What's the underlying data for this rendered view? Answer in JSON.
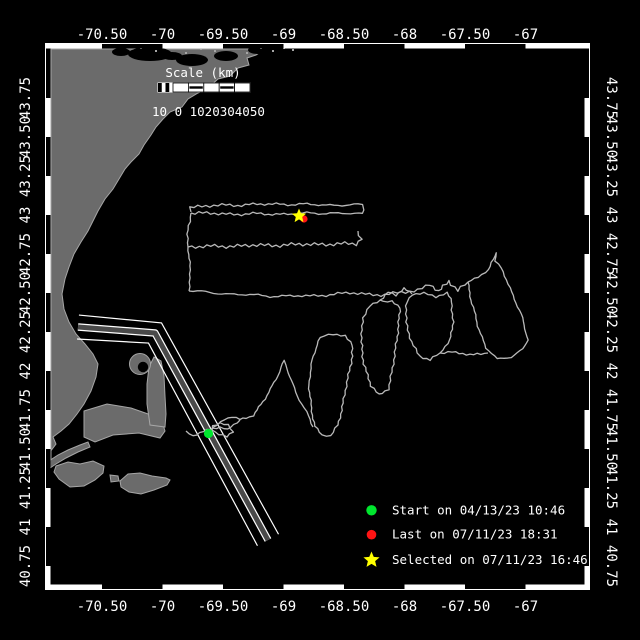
{
  "colors": {
    "background": "#000000",
    "land": "#6b6b6b",
    "land_edge": "#a6a6a6",
    "track": "#b9b9b9",
    "lane_fill": "#4a4a4a",
    "frame": "#ffffff",
    "text": "#ffffff",
    "start_green": "#00e62e",
    "last_red": "#ff1414",
    "selected_yellow": "#ffff00"
  },
  "frame": {
    "x1": 46,
    "y1": 44,
    "x2": 589,
    "y2": 589,
    "band": 4.5
  },
  "axes": {
    "lon_labels": [
      {
        "text": "-70.50",
        "x": 102
      },
      {
        "text": "-70",
        "x": 162.5
      },
      {
        "text": "-69.50",
        "x": 223
      },
      {
        "text": "-69",
        "x": 283.5
      },
      {
        "text": "-68.50",
        "x": 344
      },
      {
        "text": "-68",
        "x": 404.5
      },
      {
        "text": "-67.50",
        "x": 465
      },
      {
        "text": "-67",
        "x": 525.5
      }
    ],
    "lat_labels": [
      {
        "text": "43.75",
        "y": 98
      },
      {
        "text": "43.50",
        "y": 137
      },
      {
        "text": "43.25",
        "y": 176
      },
      {
        "text": "43",
        "y": 215
      },
      {
        "text": "42.75",
        "y": 254
      },
      {
        "text": "42.50",
        "y": 293
      },
      {
        "text": "42.25",
        "y": 332
      },
      {
        "text": "42",
        "y": 371
      },
      {
        "text": "41.75",
        "y": 410
      },
      {
        "text": "41.50",
        "y": 449
      },
      {
        "text": "41.25",
        "y": 488
      },
      {
        "text": "41",
        "y": 527
      },
      {
        "text": "40.75",
        "y": 566
      }
    ],
    "top_label_baseline": 39,
    "bottom_label_baseline": 611,
    "left_label_x": 30,
    "right_label_x": 607,
    "font_size": 14
  },
  "scalebar": {
    "title": "Scale (km)",
    "title_x": 203,
    "title_y": 77,
    "x": 158,
    "y": 83,
    "w": 92,
    "h": 9,
    "left_cells": 4,
    "left_w": 15,
    "segments": 5,
    "labels": "10 0 1020304050",
    "labels_x": 152,
    "labels_y": 116,
    "font_size": 12.5
  },
  "legend": {
    "marker_x": 371.5,
    "text_x": 392,
    "font_size": 12.5,
    "rows": [
      {
        "marker": "dot",
        "color": "start_green",
        "r": 5.2,
        "y": 510.3,
        "label": "Start on 04/13/23 10:46"
      },
      {
        "marker": "dot",
        "color": "last_red",
        "r": 4.8,
        "y": 534.7,
        "label": "Last on 07/11/23 18:31"
      },
      {
        "marker": "star",
        "color": "selected_yellow",
        "r": 8.5,
        "y": 560,
        "label": "Selected on 07/11/23 16:46"
      }
    ]
  },
  "markers": [
    {
      "name": "last-marker",
      "type": "dot",
      "color": "last_red",
      "x": 304,
      "y": 219,
      "r": 3.6
    },
    {
      "name": "selected-marker",
      "type": "star",
      "color": "selected_yellow",
      "x": 299,
      "y": 216,
      "r": 7.5
    },
    {
      "name": "start-marker",
      "type": "dot",
      "color": "start_green",
      "x": 208.5,
      "y": 433.5,
      "r": 4.6
    }
  ],
  "land": {
    "mainland": [
      [
        51,
        49
      ],
      [
        265,
        49
      ],
      [
        256,
        55
      ],
      [
        247,
        58
      ],
      [
        249,
        65
      ],
      [
        238,
        68
      ],
      [
        230,
        76
      ],
      [
        218,
        79
      ],
      [
        208,
        88
      ],
      [
        198,
        93
      ],
      [
        188,
        99
      ],
      [
        182,
        107
      ],
      [
        170,
        112
      ],
      [
        163,
        119
      ],
      [
        156,
        127
      ],
      [
        151,
        135
      ],
      [
        144,
        145
      ],
      [
        139,
        154
      ],
      [
        131,
        162
      ],
      [
        125,
        169
      ],
      [
        119,
        179
      ],
      [
        113,
        189
      ],
      [
        105,
        199
      ],
      [
        98,
        211
      ],
      [
        93,
        221
      ],
      [
        88,
        231
      ],
      [
        81,
        242
      ],
      [
        74,
        254
      ],
      [
        69,
        267
      ],
      [
        65,
        279
      ],
      [
        62,
        294
      ],
      [
        64,
        309
      ],
      [
        69,
        322
      ],
      [
        76,
        334
      ],
      [
        85,
        344
      ],
      [
        93,
        354
      ],
      [
        98,
        364
      ],
      [
        96,
        377
      ],
      [
        91,
        391
      ],
      [
        84,
        404
      ],
      [
        77,
        414
      ],
      [
        69,
        424
      ],
      [
        61,
        431
      ],
      [
        53,
        437
      ],
      [
        56,
        444
      ],
      [
        50,
        452
      ],
      [
        51,
        460
      ]
    ],
    "cape_arm": [
      [
        84,
        411
      ],
      [
        107,
        404
      ],
      [
        131,
        408
      ],
      [
        151,
        415
      ],
      [
        162,
        421
      ],
      [
        165,
        431
      ],
      [
        160,
        438
      ],
      [
        139,
        433
      ],
      [
        113,
        435
      ],
      [
        95,
        442
      ],
      [
        84,
        437
      ]
    ],
    "cape_forearm": [
      [
        150,
        425
      ],
      [
        147,
        404
      ],
      [
        147,
        384
      ],
      [
        149,
        367
      ],
      [
        154,
        357
      ],
      [
        161,
        361
      ],
      [
        164,
        376
      ],
      [
        165,
        396
      ],
      [
        166,
        414
      ],
      [
        165,
        427
      ]
    ],
    "hook": {
      "cx": 140,
      "cy": 364,
      "r": 10.5,
      "icx": 143,
      "icy": 367,
      "ir": 5.2
    },
    "islands": [
      [
        [
          49,
          461
        ],
        [
          58,
          455
        ],
        [
          68,
          450
        ],
        [
          80,
          445
        ],
        [
          88,
          442
        ],
        [
          90,
          447
        ],
        [
          78,
          452
        ],
        [
          66,
          458
        ],
        [
          56,
          464
        ],
        [
          50,
          468
        ]
      ],
      [
        [
          56,
          466
        ],
        [
          68,
          462
        ],
        [
          80,
          464
        ],
        [
          93,
          461
        ],
        [
          104,
          466
        ],
        [
          103,
          473
        ],
        [
          95,
          480
        ],
        [
          84,
          486
        ],
        [
          70,
          487
        ],
        [
          59,
          479
        ],
        [
          54,
          472
        ]
      ],
      [
        [
          110,
          475
        ],
        [
          118,
          476
        ],
        [
          119,
          481
        ],
        [
          111,
          482
        ]
      ],
      [
        [
          120,
          481
        ],
        [
          128,
          474
        ],
        [
          140,
          473
        ],
        [
          152,
          476
        ],
        [
          166,
          478
        ],
        [
          170,
          480
        ],
        [
          167,
          485
        ],
        [
          154,
          490
        ],
        [
          141,
          494
        ],
        [
          129,
          492
        ],
        [
          121,
          487
        ]
      ]
    ],
    "bays": [
      [
        150,
        54,
        22,
        7
      ],
      [
        192,
        60,
        16,
        6
      ],
      [
        226,
        56,
        12,
        5
      ],
      [
        258,
        50,
        10,
        4
      ],
      [
        121,
        52,
        9,
        4
      ],
      [
        172,
        56,
        10,
        4
      ]
    ],
    "speckles": [
      [
        140,
        47
      ],
      [
        155,
        50
      ],
      [
        168,
        46
      ],
      [
        185,
        52
      ],
      [
        200,
        48
      ],
      [
        214,
        50
      ],
      [
        230,
        47
      ],
      [
        246,
        52
      ],
      [
        260,
        47
      ],
      [
        272,
        50
      ],
      [
        283,
        47
      ],
      [
        292,
        49
      ]
    ]
  },
  "lane": {
    "center": [
      [
        78,
        327
      ],
      [
        155,
        333
      ],
      [
        268,
        540
      ]
    ],
    "offset": 12,
    "band_outer_w": 7.5,
    "band_inner_w": 5,
    "line_w": 1.2
  },
  "track": {
    "polylines": [
      {
        "amp": 1.6,
        "pts": [
          [
            191,
            212
          ],
          [
            190,
            207
          ],
          [
            230,
            205
          ],
          [
            280,
            204
          ],
          [
            330,
            205
          ],
          [
            362,
            205
          ],
          [
            364,
            210
          ],
          [
            363,
            214
          ],
          [
            330,
            213
          ],
          [
            280,
            214
          ],
          [
            230,
            214
          ],
          [
            191,
            213
          ]
        ]
      },
      {
        "amp": 0.8,
        "pts": [
          [
            191,
            213
          ],
          [
            188,
            230
          ],
          [
            188,
            247
          ]
        ]
      },
      {
        "amp": 1.6,
        "pts": [
          [
            188,
            247
          ],
          [
            230,
            246
          ],
          [
            280,
            245
          ],
          [
            330,
            244
          ],
          [
            356,
            244
          ],
          [
            361,
            239
          ],
          [
            358,
            231
          ]
        ]
      },
      {
        "amp": 0.8,
        "pts": [
          [
            188,
            247
          ],
          [
            190,
            262
          ],
          [
            190,
            278
          ],
          [
            189,
            291
          ]
        ]
      },
      {
        "amp": 1.5,
        "pts": [
          [
            189,
            291
          ],
          [
            230,
            294
          ],
          [
            270,
            296
          ],
          [
            310,
            296
          ],
          [
            350,
            293
          ],
          [
            385,
            295
          ],
          [
            418,
            290
          ],
          [
            430,
            284
          ],
          [
            439,
            292
          ],
          [
            449,
            281
          ],
          [
            458,
            290
          ],
          [
            468,
            282
          ]
        ]
      },
      {
        "amp": 0.9,
        "pts": [
          [
            468,
            282
          ],
          [
            471,
            300
          ],
          [
            478,
            326
          ],
          [
            486,
            348
          ],
          [
            497,
            359
          ],
          [
            511,
            357
          ],
          [
            523,
            349
          ],
          [
            528,
            340
          ],
          [
            521,
            314
          ],
          [
            510,
            288
          ],
          [
            501,
            268
          ],
          [
            495,
            261
          ],
          [
            497,
            252
          ],
          [
            493,
            259
          ],
          [
            489,
            270
          ],
          [
            478,
            277
          ],
          [
            468,
            282
          ]
        ]
      },
      {
        "amp": 1.0,
        "pts": [
          [
            488,
            353
          ],
          [
            470,
            355
          ],
          [
            452,
            352
          ],
          [
            440,
            353
          ]
        ]
      },
      {
        "amp": 0.9,
        "pts": [
          [
            440,
            353
          ],
          [
            430,
            360
          ],
          [
            420,
            356
          ],
          [
            411,
            342
          ],
          [
            406,
            322
          ],
          [
            407,
            302
          ],
          [
            412,
            294
          ],
          [
            424,
            293
          ],
          [
            436,
            297
          ],
          [
            447,
            293
          ],
          [
            452,
            302
          ],
          [
            453,
            322
          ],
          [
            450,
            340
          ],
          [
            440,
            353
          ]
        ]
      },
      {
        "amp": 0.9,
        "pts": [
          [
            412,
            294
          ],
          [
            404,
            288
          ],
          [
            396,
            296
          ],
          [
            388,
            292
          ],
          [
            380,
            300
          ],
          [
            370,
            306
          ],
          [
            363,
            318
          ],
          [
            361,
            342
          ],
          [
            364,
            364
          ],
          [
            371,
            386
          ],
          [
            379,
            395
          ],
          [
            388,
            389
          ],
          [
            393,
            368
          ],
          [
            396,
            344
          ],
          [
            399,
            322
          ],
          [
            400,
            308
          ],
          [
            392,
            301
          ],
          [
            383,
            302
          ],
          [
            380,
            300
          ]
        ]
      },
      {
        "amp": 0.9,
        "pts": [
          [
            318,
            341
          ],
          [
            312,
            360
          ],
          [
            309,
            385
          ],
          [
            311,
            408
          ],
          [
            315,
            426
          ],
          [
            322,
            435
          ],
          [
            331,
            436
          ],
          [
            338,
            425
          ],
          [
            343,
            403
          ],
          [
            348,
            378
          ],
          [
            352,
            356
          ],
          [
            353,
            345
          ],
          [
            345,
            336
          ],
          [
            333,
            334
          ],
          [
            324,
            336
          ],
          [
            318,
            341
          ]
        ]
      },
      {
        "amp": 1.2,
        "pts": [
          [
            313,
            427
          ],
          [
            308,
            416
          ],
          [
            302,
            404
          ],
          [
            296,
            392
          ],
          [
            291,
            380
          ],
          [
            287,
            369
          ],
          [
            284,
            361
          ],
          [
            281,
            367
          ],
          [
            277,
            376
          ],
          [
            271,
            389
          ],
          [
            265,
            399
          ],
          [
            259,
            407
          ],
          [
            253,
            415
          ],
          [
            246,
            418
          ],
          [
            240,
            420
          ],
          [
            232,
            417
          ],
          [
            224,
            419
          ],
          [
            217,
            425
          ],
          [
            211,
            430
          ],
          [
            209,
            434
          ]
        ]
      },
      {
        "amp": 1.0,
        "pts": [
          [
            186,
            431
          ],
          [
            193,
            436
          ],
          [
            200,
            433
          ],
          [
            207,
            430
          ],
          [
            213,
            428
          ],
          [
            220,
            427
          ],
          [
            228,
            430
          ],
          [
            234,
            425
          ],
          [
            240,
            420
          ]
        ]
      },
      {
        "amp": 0.8,
        "pts": [
          [
            212,
            430
          ],
          [
            219,
            434
          ],
          [
            227,
            437
          ],
          [
            233,
            432
          ],
          [
            228,
            425
          ],
          [
            220,
            423
          ],
          [
            213,
            426
          ],
          [
            212,
            430
          ]
        ]
      }
    ]
  }
}
